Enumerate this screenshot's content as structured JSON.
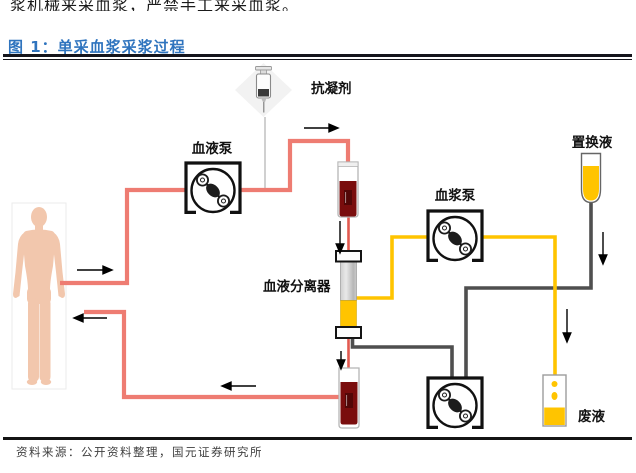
{
  "page": {
    "top_cut_text": "浆机械来采血浆，严禁手工来采血浆。",
    "figure_title": "图 1：单采血浆采浆过程",
    "source_text": "资料来源：公开资料整理，国元证券研究所"
  },
  "diagram": {
    "labels": {
      "blood_pump": "血液泵",
      "anticoagulant": "抗凝剂",
      "replacement_fluid": "置换液",
      "plasma_pump": "血浆泵",
      "blood_separator": "血液分离器",
      "waste_fluid": "废液"
    },
    "icons": {
      "donor": "person-silhouette-icon",
      "anticoagulant": "syringe-icon",
      "pumps": "peristaltic-pump-icon",
      "tubes": "blood-tube-icon",
      "separator": "separator-column-icon",
      "replacement": "fluid-bottle-icon",
      "waste": "waste-container-icon"
    },
    "colors": {
      "title_blue": "#2F74BE",
      "line_red": "#EE7C72",
      "blood_dark_red": "#7A0D0D",
      "plasma_yellow": "#FFC400",
      "line_gray": "#4F4F4F",
      "skin_tone": "#F2C7AD"
    }
  }
}
